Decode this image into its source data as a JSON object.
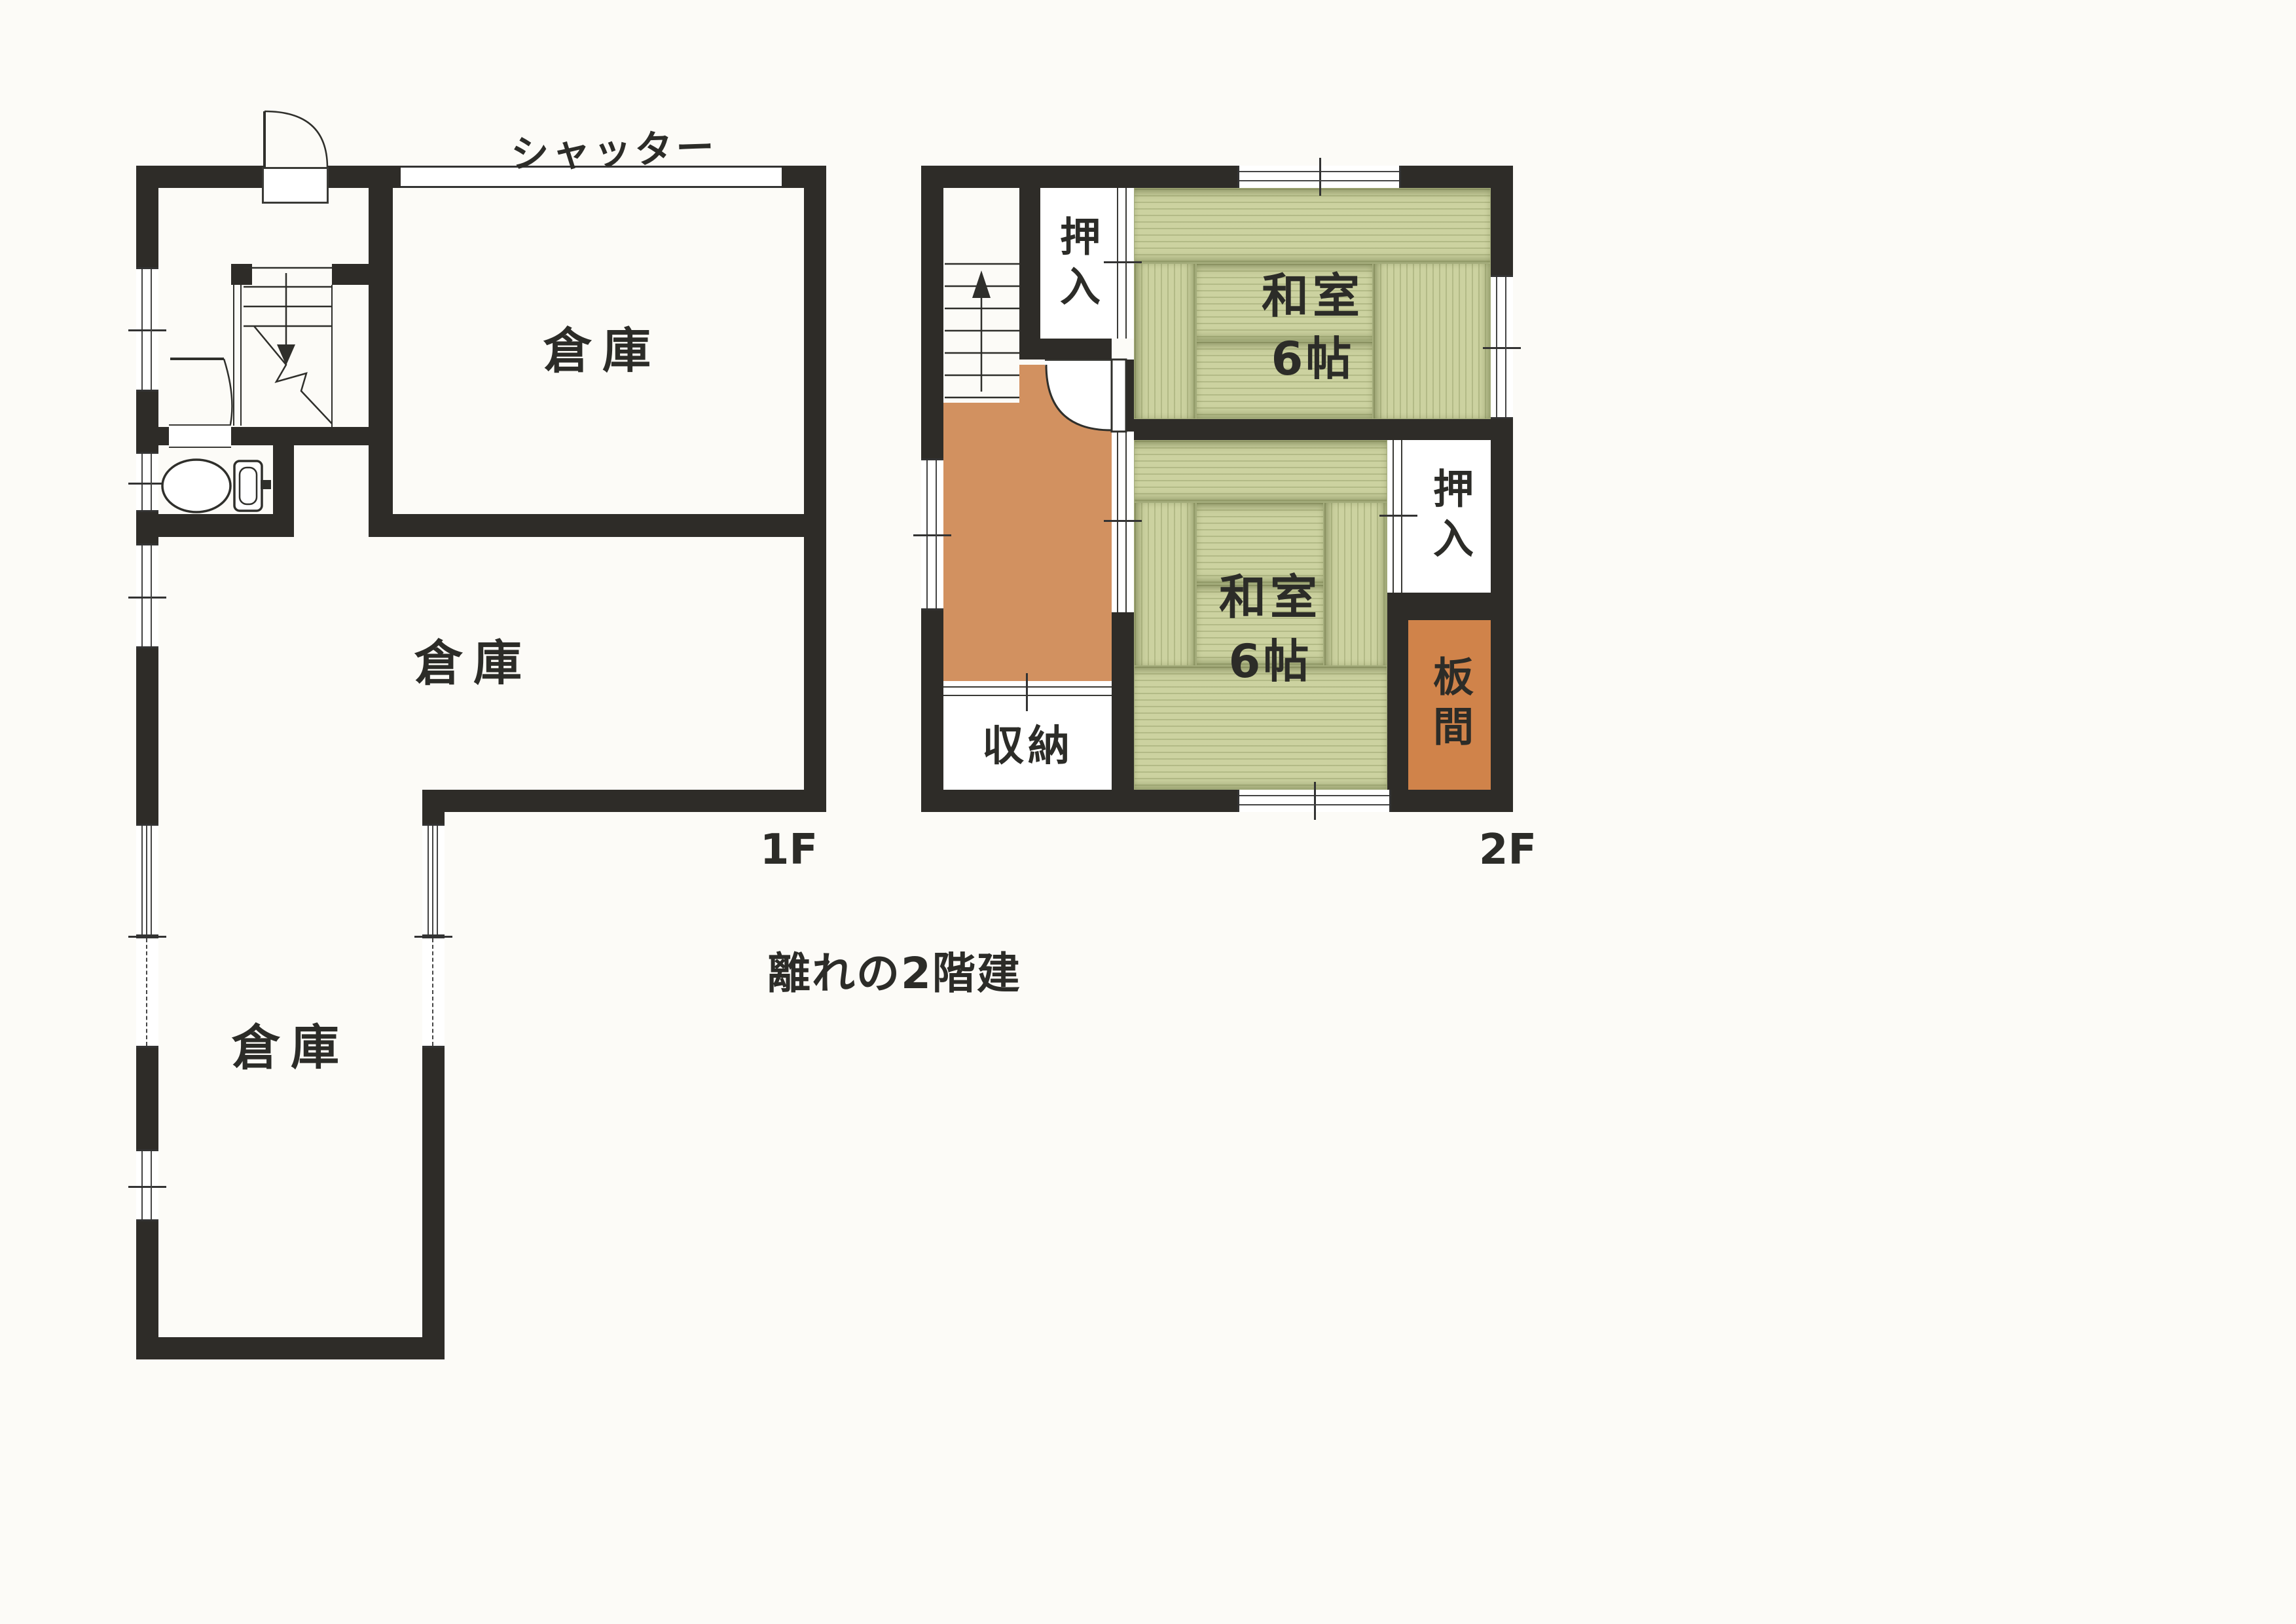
{
  "caption": "離れの2階建",
  "floor1": {
    "label": "1F",
    "shutter": "シャッター",
    "storage_top": "倉庫",
    "storage_middle": "倉庫",
    "storage_lower": "倉庫"
  },
  "floor2": {
    "label": "2F",
    "washitsu1_line1": "和室",
    "washitsu1_line2": "6帖",
    "washitsu2_line1": "和室",
    "washitsu2_line2": "6帖",
    "oshiire_top": "押入",
    "oshiire_right": "押入",
    "shuno": "収納",
    "itanoma": "板間"
  },
  "colors": {
    "wall": "#2e2c28",
    "tatami": "#ccd2a0",
    "wood_floor": "#d29160",
    "itanoma_floor": "#d0834a"
  }
}
